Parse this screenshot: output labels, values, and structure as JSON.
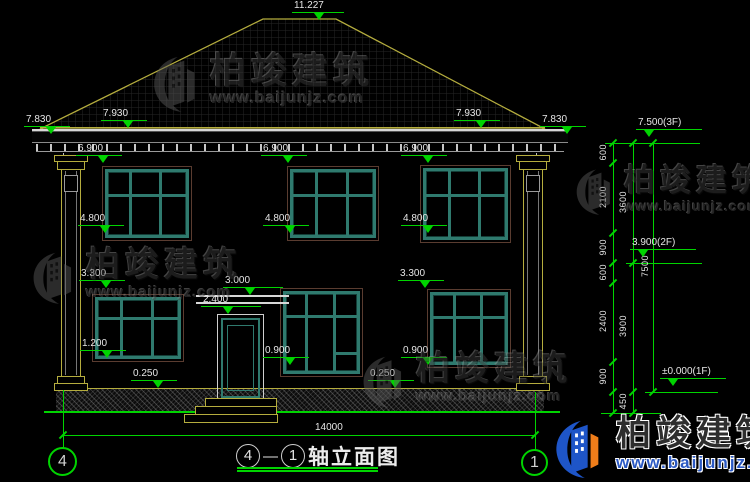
{
  "watermark": {
    "brand": "柏竣建筑",
    "site": "www.baijunjz.com"
  },
  "markers": {
    "ridge": "11.227",
    "eave_outer": "7.830",
    "eave_inner": "7.930",
    "win2_top": "6.900",
    "win2_sill": "4.800",
    "win1_top": "3.300",
    "canopy": "3.000",
    "door_top": "2.400",
    "win1_left_sill": "1.200",
    "win1_sill": "0.900",
    "plinth_top": "0.250",
    "level_3f": "7.500(3F)",
    "level_2f": "3.900(2F)",
    "level_1f": "±0.000(1F)"
  },
  "dim_chain": {
    "col_a": [
      "600",
      "2100",
      "900",
      "600",
      "2400",
      "900"
    ],
    "col_b": [
      "3600",
      "3900",
      "450"
    ],
    "total": "7500"
  },
  "plan_dim": {
    "overall_width": "14000"
  },
  "axes": {
    "left": "4",
    "right": "1"
  },
  "title": {
    "text": "轴立面图",
    "separator": "—"
  },
  "colors": {
    "dimension_green": "#00d400",
    "outline_yellow": "#b5ad3e",
    "window_teal": "#2f7a6e",
    "logo_blue": "#1e55c8",
    "logo_orange": "#ef7d1a"
  }
}
